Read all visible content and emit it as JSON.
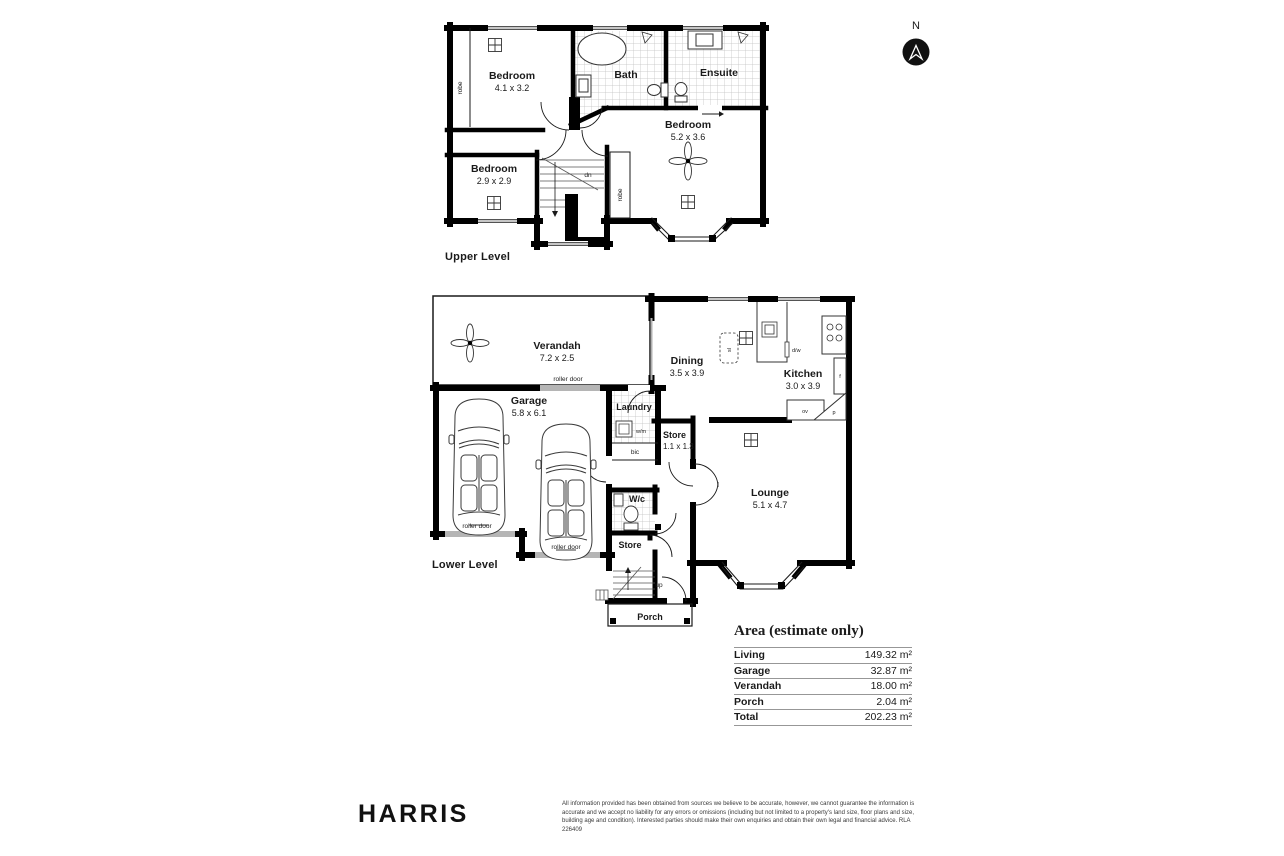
{
  "north": {
    "label": "N"
  },
  "upper": {
    "caption": "Upper Level",
    "bedroom1": {
      "name": "Bedroom",
      "dims": "4.1 x 3.2"
    },
    "bedroom2": {
      "name": "Bedroom",
      "dims": "2.9 x 2.9"
    },
    "bedroom3": {
      "name": "Bedroom",
      "dims": "5.2 x 3.6"
    },
    "bath": "Bath",
    "ensuite": "Ensuite",
    "robe": "robe",
    "dn": "dn"
  },
  "lower": {
    "caption": "Lower Level",
    "verandah": {
      "name": "Verandah",
      "dims": "7.2 x 2.5"
    },
    "garage": {
      "name": "Garage",
      "dims": "5.8 x 6.1"
    },
    "dining": {
      "name": "Dining",
      "dims": "3.5 x 3.9"
    },
    "kitchen": {
      "name": "Kitchen",
      "dims": "3.0 x 3.9"
    },
    "store1": {
      "name": "Store",
      "dims": "1.1 x 1.3"
    },
    "lounge": {
      "name": "Lounge",
      "dims": "5.1 x 4.7"
    },
    "laundry": "Laundry",
    "wc": "W/c",
    "store2": "Store",
    "porch": "Porch",
    "roller_door": "roller door",
    "wm": "w/m",
    "bic": "bic",
    "up": "up",
    "sl": "sl",
    "dw": "d/w",
    "fridge": "f",
    "oven": "ov",
    "pantry": "p"
  },
  "area_table": {
    "title": "Area (estimate only)",
    "rows": [
      {
        "label": "Living",
        "value": "149.32 m²"
      },
      {
        "label": "Garage",
        "value": "32.87 m²"
      },
      {
        "label": "Verandah",
        "value": "18.00 m²"
      },
      {
        "label": "Porch",
        "value": "2.04 m²"
      },
      {
        "label": "Total",
        "value": "202.23 m²"
      }
    ]
  },
  "footer": {
    "brand": "HARRIS",
    "disclaimer": "All information provided has been obtained from sources we believe to be accurate, however, we cannot guarantee the information is accurate and we accept no liability for any errors or omissions (including but not limited to a property's land size, floor plans and size, building age and condition). Interested parties should make their own enquiries and obtain their own legal and financial advice. RLA 226409"
  }
}
